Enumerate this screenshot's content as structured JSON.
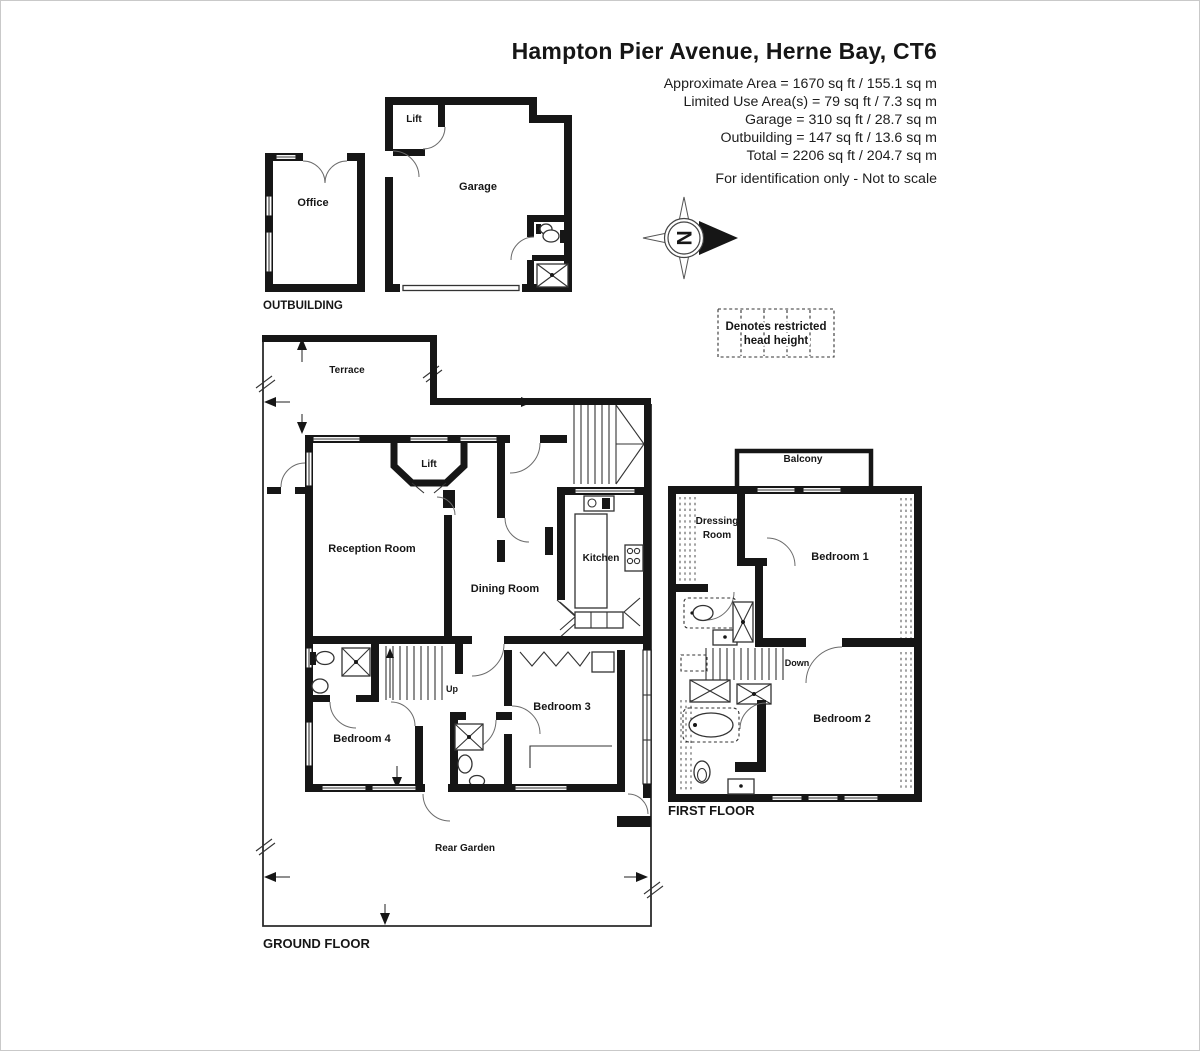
{
  "header": {
    "title": "Hampton Pier Avenue, Herne Bay, CT6",
    "area_lines": [
      "Approximate Area = 1670 sq ft / 155.1 sq m",
      "Limited Use Area(s) = 79 sq ft / 7.3 sq m",
      "Garage = 310 sq ft / 28.7 sq m",
      "Outbuilding = 147 sq ft / 13.6 sq m",
      "Total = 2206 sq ft / 204.7 sq m"
    ],
    "disclaimer": "For identification only - Not to scale"
  },
  "legend": {
    "restricted_line1": "Denotes restricted",
    "restricted_line2": "head height"
  },
  "compass": {
    "north": "N"
  },
  "outbuilding": {
    "label": "OUTBUILDING",
    "office": "Office"
  },
  "garage_building": {
    "lift": "Lift",
    "garage": "Garage"
  },
  "ground_floor": {
    "label": "GROUND FLOOR",
    "terrace": "Terrace",
    "lift": "Lift",
    "reception": "Reception Room",
    "dining": "Dining Room",
    "kitchen": "Kitchen",
    "up": "Up",
    "bedroom4": "Bedroom 4",
    "bedroom3": "Bedroom 3",
    "rear_garden": "Rear Garden"
  },
  "first_floor": {
    "label": "FIRST FLOOR",
    "balcony": "Balcony",
    "dressing_line1": "Dressing",
    "dressing_line2": "Room",
    "bedroom1": "Bedroom 1",
    "down": "Down",
    "bedroom2": "Bedroom 2"
  },
  "colors": {
    "wall": "#161616",
    "background": "#ffffff",
    "page_border": "#c9c9c9"
  }
}
